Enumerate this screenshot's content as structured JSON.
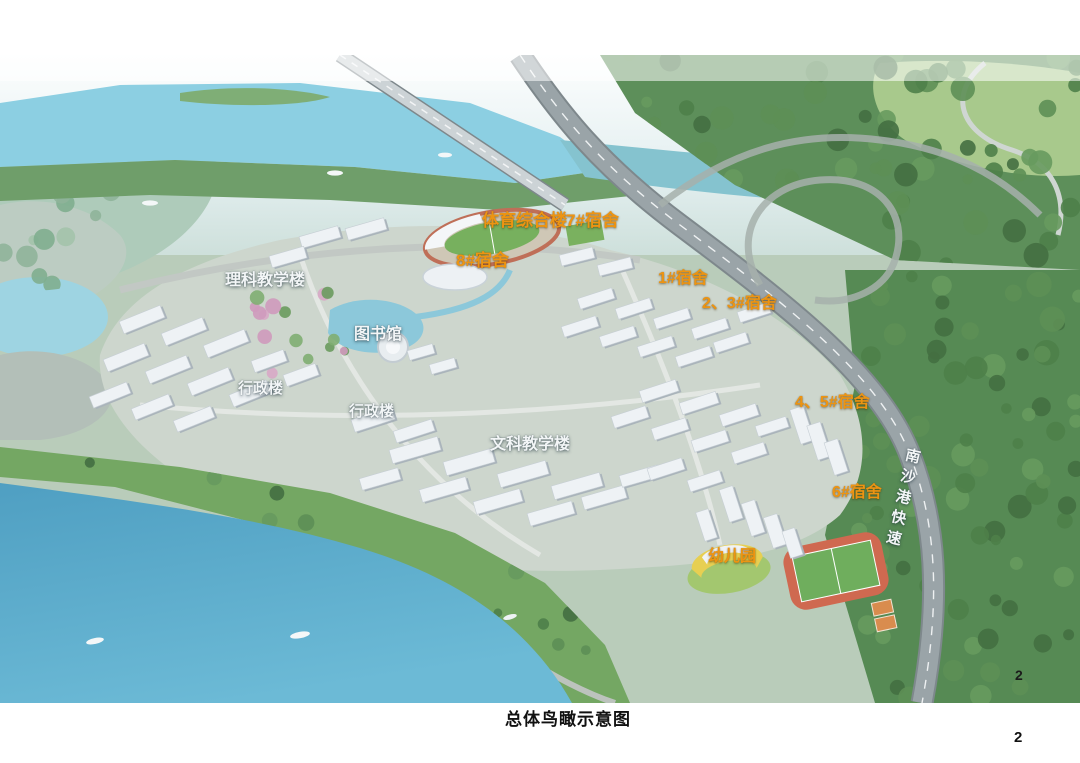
{
  "page": {
    "caption": "总体鸟瞰示意图",
    "page_number": "2",
    "page_number_on_image": "2"
  },
  "labels": {
    "sports_complex": "体育综合楼",
    "dorm_7": "7#宿舍",
    "dorm_8": "8#宿舍",
    "science_teaching": "理科教学楼",
    "dorm_1": "1#宿舍",
    "dorm_2_3": "2、3#宿舍",
    "library": "图书馆",
    "admin_west": "行政楼",
    "admin_central": "行政楼",
    "arts_teaching": "文科教学楼",
    "dorm_4_5": "4、5#宿舍",
    "dorm_6": "6#宿舍",
    "kindergarten": "幼儿园",
    "expressway": "南沙港快速"
  },
  "colors": {
    "dorm_label": "#ED9412",
    "building_label": "#F3F6F7",
    "caption_text": "#111111"
  }
}
